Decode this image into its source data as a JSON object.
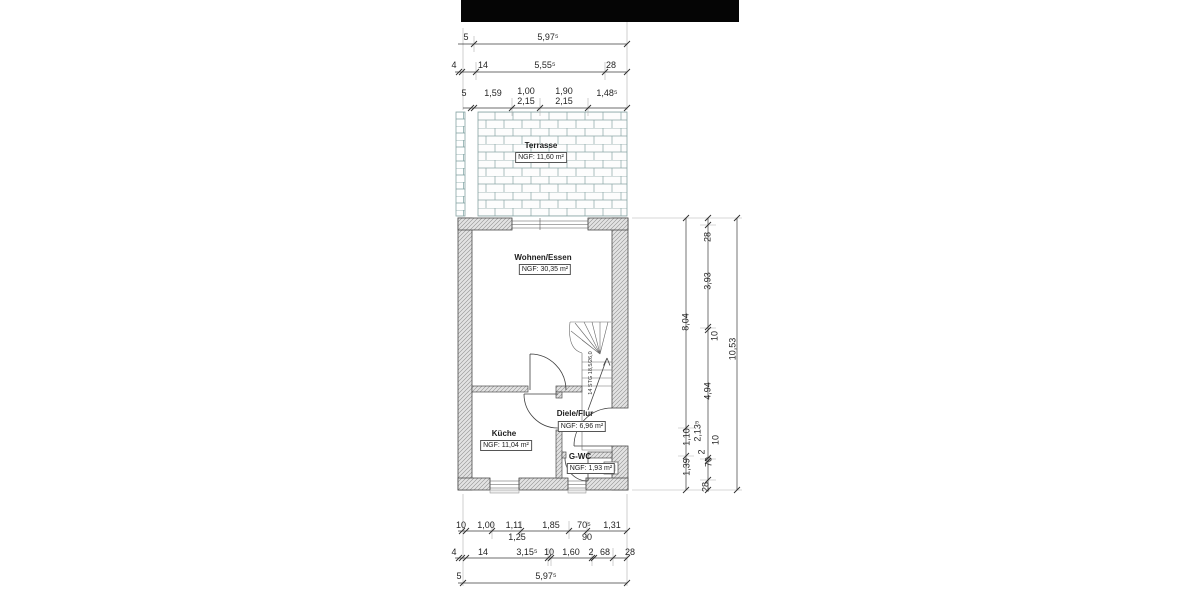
{
  "drawing": {
    "rooms": [
      {
        "name": "Terrasse",
        "area": "NGF: 11,60 m²"
      },
      {
        "name": "Wohnen/Essen",
        "area": "NGF: 30,35 m²"
      },
      {
        "name": "Küche",
        "area": "NGF: 11,04 m²"
      },
      {
        "name": "Diele/Flur",
        "area": "NGF: 6,96 m²"
      },
      {
        "name": "G-WC",
        "area": "NGF: 1,93 m²"
      }
    ],
    "stair_note": "14 STG 18,5/26,0"
  },
  "dims": {
    "top1": {
      "pre": "5",
      "span": "5,97⁵"
    },
    "top2": {
      "a": "4",
      "b": "14",
      "span": "5,55⁵",
      "c": "28"
    },
    "top3": {
      "pre": "5",
      "s1": "1,59",
      "s2": "1,00",
      "s2h": "2,15",
      "s3": "1,90",
      "s3h": "2,15",
      "s4": "1,48⁵"
    },
    "bot1": {
      "a": "10",
      "b": "1,00",
      "c": "1,11",
      "ch": "1,25",
      "d": "1,85",
      "e": "70⁵",
      "eh": "90",
      "f": "1,31"
    },
    "bot2": {
      "a": "4",
      "b": "14",
      "c": "3,15⁵",
      "d": "10",
      "e": "1,60",
      "f": "2",
      "g": "68",
      "h": "28"
    },
    "bot3": {
      "pre": "5",
      "span": "5,97⁵"
    },
    "right_inner": {
      "a": "8,04",
      "b": "1,10",
      "bh": "2,13⁵",
      "c": "1,39"
    },
    "right_mid": {
      "a": "28",
      "b": "3,93",
      "c": "10",
      "d": "4,94",
      "e": "10",
      "f": "2",
      "g": "70",
      "h": "28"
    },
    "right_outer": {
      "total": "10,53"
    }
  },
  "colors": {
    "header_bar": "#050505",
    "dimension_line": "#3c3c3c",
    "wall_hatch": "#909090",
    "paving_line": "#86a2a2"
  }
}
